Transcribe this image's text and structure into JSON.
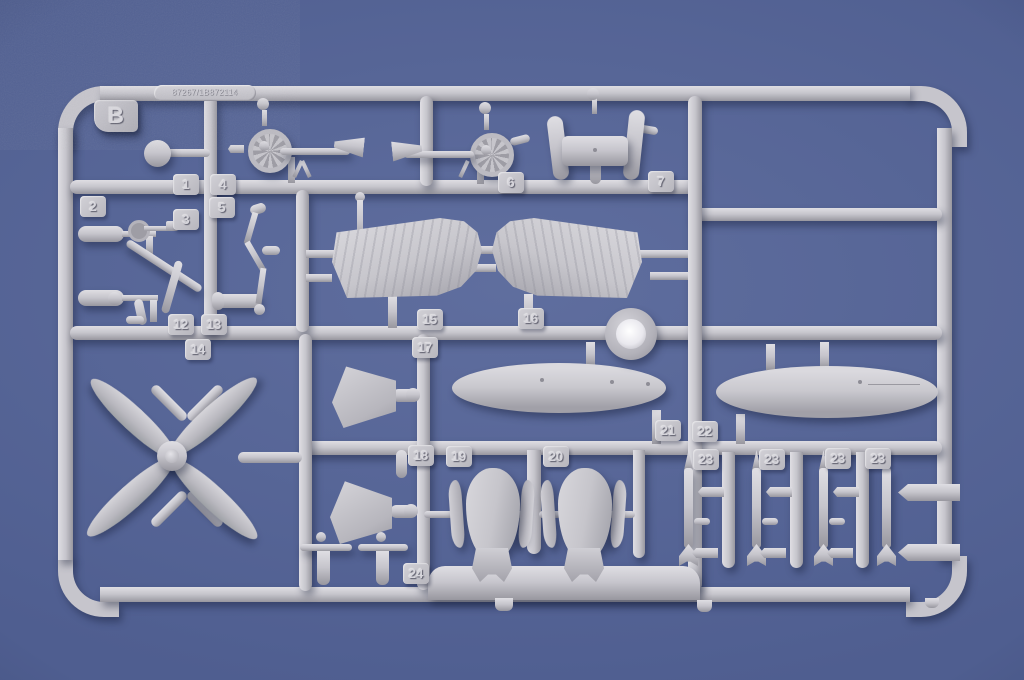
{
  "sprue": {
    "letter": "B",
    "mold_code": "87267/1B872114",
    "part_tags": {
      "p1": "1",
      "p2": "2",
      "p3": "3",
      "p4": "4",
      "p5": "5",
      "p6": "6",
      "p7": "7",
      "p12": "12",
      "p13": "13",
      "p14": "14",
      "p15": "15",
      "p16": "16",
      "p17": "17",
      "p18": "18",
      "p19": "19",
      "p20": "20",
      "p21": "21",
      "p22": "22",
      "p23a": "23",
      "p23b": "23",
      "p23c": "23",
      "p23d": "23",
      "p24": "24"
    }
  },
  "colors": {
    "background_blue": "#4f5e90",
    "plastic_base": "#c6c5cc",
    "plastic_highlight": "#dfdee3",
    "plastic_shadow": "#98979f",
    "clear_part_center": "#eceaf0"
  }
}
